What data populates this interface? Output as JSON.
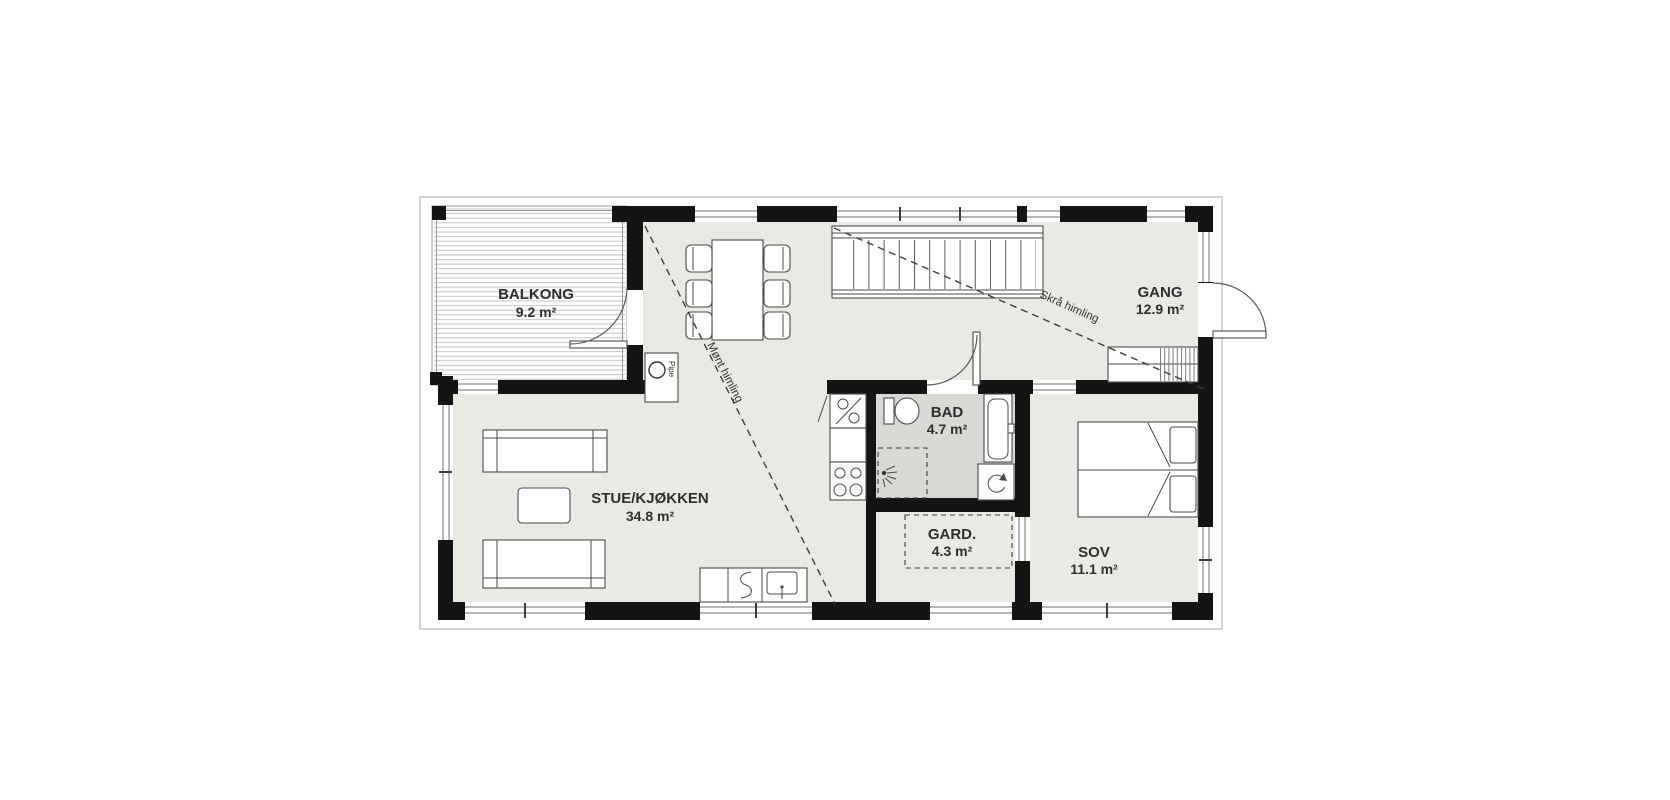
{
  "plan_title": "Floor plan",
  "units": "m²",
  "rooms": {
    "balkong": {
      "name": "BALKONG",
      "area": "9.2 m²"
    },
    "stue": {
      "name": "STUE/KJØKKEN",
      "area": "34.8 m²"
    },
    "gang": {
      "name": "GANG",
      "area": "12.9 m²"
    },
    "bad": {
      "name": "BAD",
      "area": "4.7 m²"
    },
    "gard": {
      "name": "GARD.",
      "area": "4.3 m²"
    },
    "sov": {
      "name": "SOV",
      "area": "11.1 m²"
    }
  },
  "annotations": {
    "ridge_ceiling": "Mønt himling",
    "sloped_ceiling": "Skrå himling",
    "chimney": "Pipe"
  },
  "colors": {
    "wall": "#141414",
    "floor": "#eae9e4",
    "bathfloor": "#d9d8d4",
    "bg": "#ffffff"
  }
}
